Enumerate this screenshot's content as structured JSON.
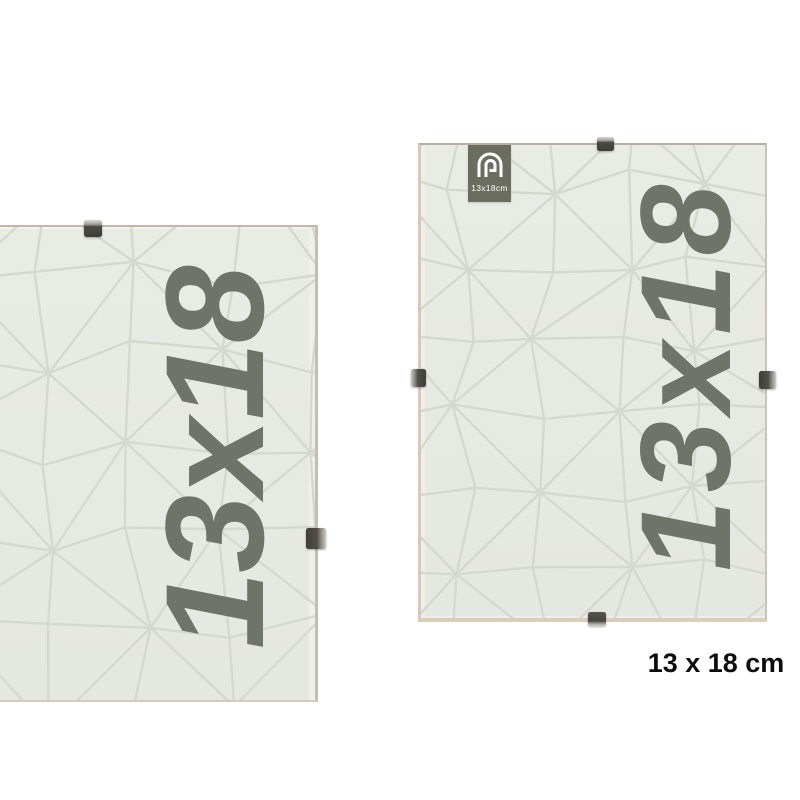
{
  "left_frame": {
    "overlay_text": "13x18"
  },
  "right_frame": {
    "overlay_text": "13x18",
    "label": {
      "text": "13x18cm"
    }
  },
  "caption": "13 x 18 cm",
  "colors": {
    "frame-background": "#e9ece4",
    "pattern-line": "#d4d8ce",
    "overlay-text": "#70736a",
    "label-background": "#6b6d60",
    "label-text": "#ffffff",
    "frame-edge": "#d6c9bb",
    "clip-dark": "#4c4b46",
    "clip-metal": "#d9d7d1",
    "caption-text": "#0d0d0d"
  }
}
